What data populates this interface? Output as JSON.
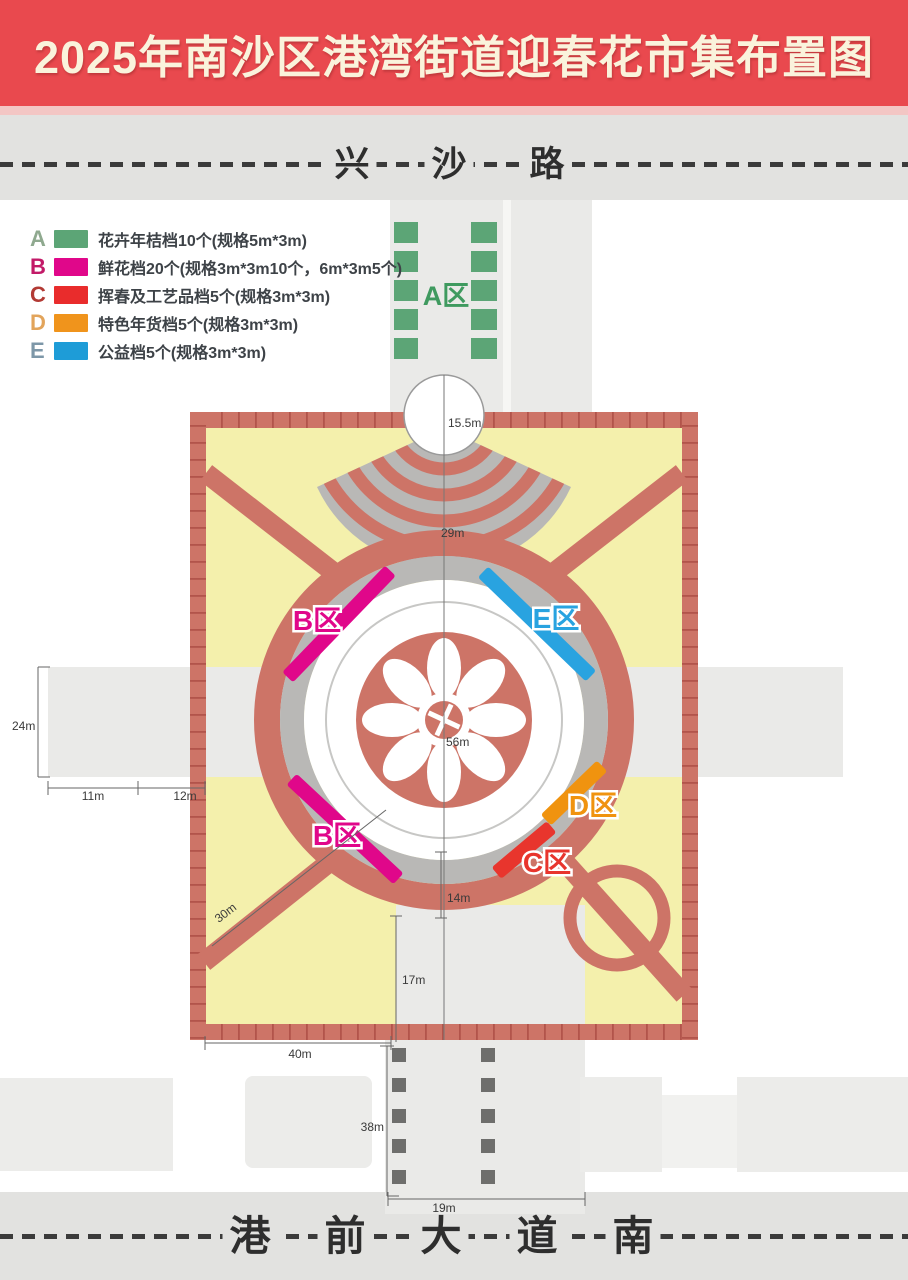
{
  "title": "2025年南沙区港湾街道迎春花市集布置图",
  "roads": {
    "top": {
      "name": "兴沙路",
      "chars": [
        "兴",
        "沙",
        "路"
      ]
    },
    "bottom": {
      "name": "港前大道南",
      "chars": [
        "港",
        "前",
        "大",
        "道",
        "南"
      ]
    }
  },
  "legend": {
    "items": [
      {
        "letter": "A",
        "label": "花卉年桔档10个(规格5m*3m)",
        "color": "#5ca576",
        "letter_color": "#8fa98f"
      },
      {
        "letter": "B",
        "label": "鲜花档20个(规格3m*3m10个，6m*3m5个)",
        "color": "#e0078a",
        "letter_color": "#c21a68"
      },
      {
        "letter": "C",
        "label": "挥春及工艺品档5个(规格3m*3m)",
        "color": "#e92c2c",
        "letter_color": "#b23a34"
      },
      {
        "letter": "D",
        "label": "特色年货档5个(规格3m*3m)",
        "color": "#f0941c",
        "letter_color": "#e2a45b"
      },
      {
        "letter": "E",
        "label": "公益档5个(规格3m*3m)",
        "color": "#1e9cd7",
        "letter_color": "#7d97a8"
      }
    ]
  },
  "zones": {
    "a": "A区",
    "b": "B区",
    "c": "C区",
    "d": "D区",
    "e": "E区"
  },
  "zone_colors": {
    "a": "#3f9a5f",
    "b": "#e0078a",
    "c": "#e8352d",
    "d": "#f0930f",
    "e": "#29a3e0"
  },
  "dimensions": {
    "entrance_width": "15.5m",
    "ring_top": "29m",
    "center_diameter": "56m",
    "ring_bottom_gap": "14m",
    "south_inner_gap": "17m",
    "west_corridor_width": "24m",
    "west_seg_a": "11m",
    "west_seg_b": "12m",
    "diagonal_path": "30m",
    "south_yard_width": "40m",
    "south_corridor_length": "38m",
    "south_corridor_width": "19m"
  },
  "colors": {
    "header_bg": "#e9494e",
    "header_text": "#faf3dc",
    "road_bg": "#e2e2e0",
    "salmon": "#cd7467",
    "brick_line": "#b2544b",
    "gray_ring": "#b9b8b6",
    "plaza_yellow": "#f4f0ac",
    "corridor_gray": "#eaeae8",
    "building_gray": "#ececea",
    "bollard_gray": "#6e6e6c"
  }
}
